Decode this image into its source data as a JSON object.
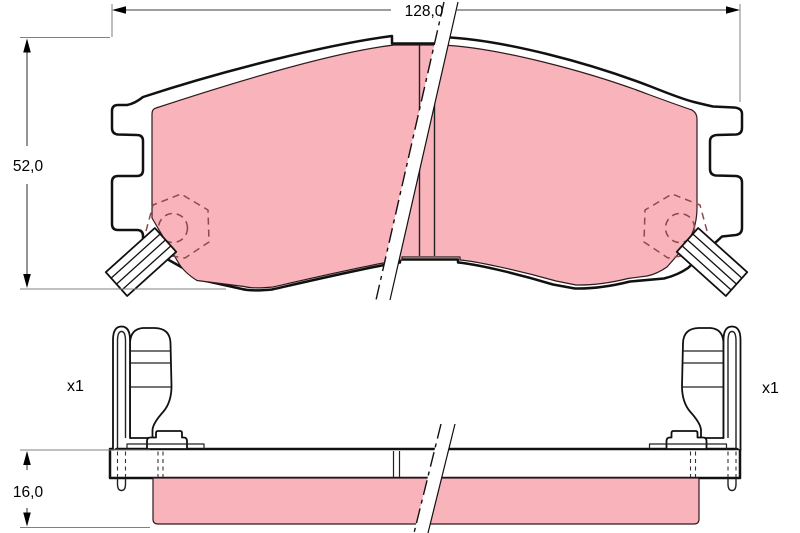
{
  "drawing": {
    "front_view": {
      "width_label": "128,0",
      "height_label": "52,0"
    },
    "side_view": {
      "thickness_label": "16,0"
    },
    "accessories": {
      "left_qty": "x1",
      "right_qty": "x1"
    }
  },
  "colors": {
    "friction_material": "#f8b3bb",
    "hidden_detail": "#8d4a4e",
    "outline": "#111111",
    "background": "#ffffff"
  }
}
